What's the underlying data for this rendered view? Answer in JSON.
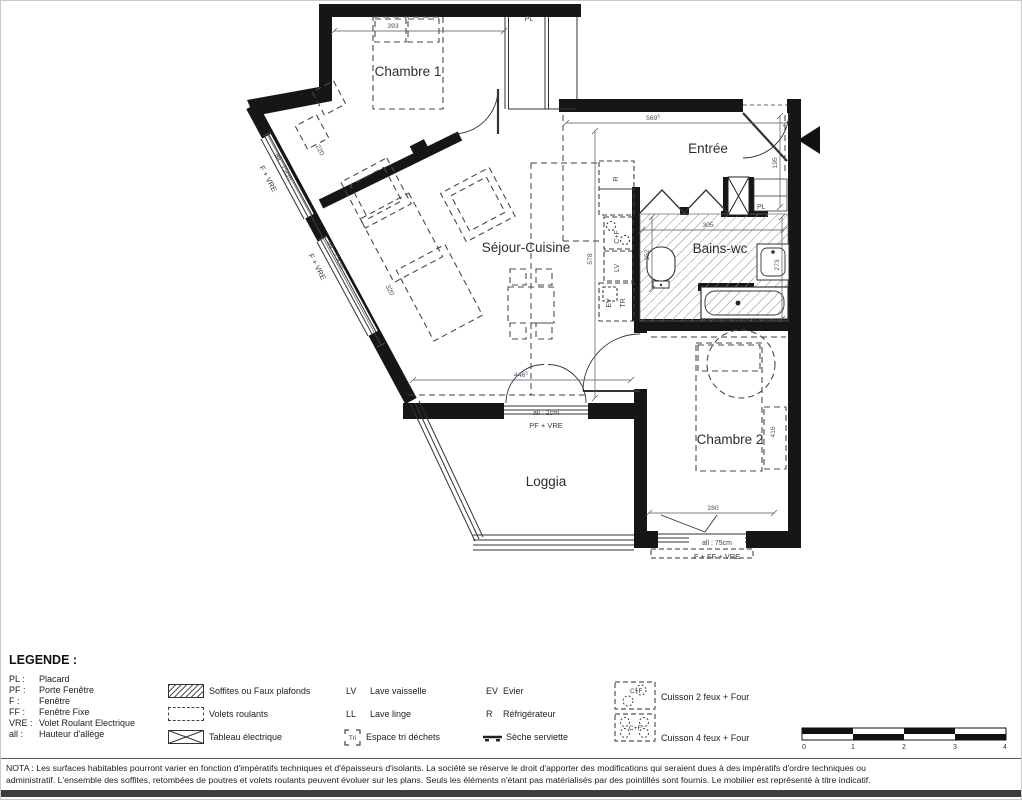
{
  "plan": {
    "rooms": {
      "chambre1": "Chambre 1",
      "sejour": "Séjour-Cuisine",
      "entree": "Entrée",
      "bains": "Bains-wc",
      "chambre2": "Chambre 2",
      "loggia": "Loggia"
    },
    "dims": {
      "w_chambre1": "393",
      "w_entree": "569",
      "w_entree_sup": "5",
      "h_entree": "195",
      "h_sejour": "578",
      "w_bains": "305",
      "h_wc": "152",
      "h_bains": "273",
      "w_sejour": "446",
      "w_sejour_sup": "5",
      "w_chambre2": "280",
      "h_lit2": "416",
      "diag1": "220",
      "diag2": "320"
    },
    "tags": {
      "pl_chambre1": "PL",
      "pl_entree": "PL",
      "fridge": "R",
      "hob": "C+F",
      "dishwasher": "LV",
      "sink": "EV",
      "tri": "TR",
      "win1_allege": "all : 75cm",
      "win1_type": "F + VRE",
      "win2_allege": "all : 75cm",
      "win2_type": "F + VRE",
      "loggia_allege": "all : 2cm",
      "loggia_type": "PF + VRE",
      "ch2_allege": "all : 75cm",
      "ch2_type": "F + FF + VRE"
    }
  },
  "legend": {
    "title": "LEGENDE :",
    "abbreviations": [
      {
        "abbr": "PL :",
        "label": "Placard"
      },
      {
        "abbr": "PF :",
        "label": "Porte Fenêtre"
      },
      {
        "abbr": "F :",
        "label": "Fenêtre"
      },
      {
        "abbr": "FF :",
        "label": "Fenêtre Fixe"
      },
      {
        "abbr": "VRE :",
        "label": "Volet Roulant Electrique"
      },
      {
        "abbr": "all :",
        "label": "Hauteur d'allège"
      }
    ],
    "symbols": [
      {
        "label": "Soffites ou Faux plafonds"
      },
      {
        "label": "Volets roulants"
      },
      {
        "label": "Tableau électrique"
      }
    ],
    "appliances": [
      {
        "abbr": "LV",
        "label": "Lave vaisselle"
      },
      {
        "abbr": "LL",
        "label": "Lave linge"
      },
      {
        "abbr": "Tri",
        "label": "Espace tri déchets"
      },
      {
        "abbr": "EV",
        "label": "Evier"
      },
      {
        "abbr": "R",
        "label": "Réfrigérateur"
      },
      {
        "abbr": "",
        "label": "Sèche serviette"
      }
    ],
    "cooking": [
      {
        "icon_text": "C+F",
        "label": "Cuisson 2 feux + Four"
      },
      {
        "icon_text": "C+F",
        "label": "Cuisson 4 feux + Four"
      }
    ],
    "scale_ticks": [
      "0",
      "1",
      "2",
      "3",
      "4"
    ]
  },
  "nota": {
    "line1": "NOTA : Les surfaces habitables pourront varier en fonction d'impératifs techniques et d'épaisseurs d'isolants. La société se réserve le droit d'apporter des modifications qui seraient dues à des impératifs d'ordre techniques ou",
    "line2": "administratif. L'ensemble des soffites, retombées de poutres et volets roulants peuvent évoluer sur les plans. Seuls les éléments n'étant pas matérialisés par des pointillés sont fournis. Le mobilier est représenté à titre indicatif."
  }
}
